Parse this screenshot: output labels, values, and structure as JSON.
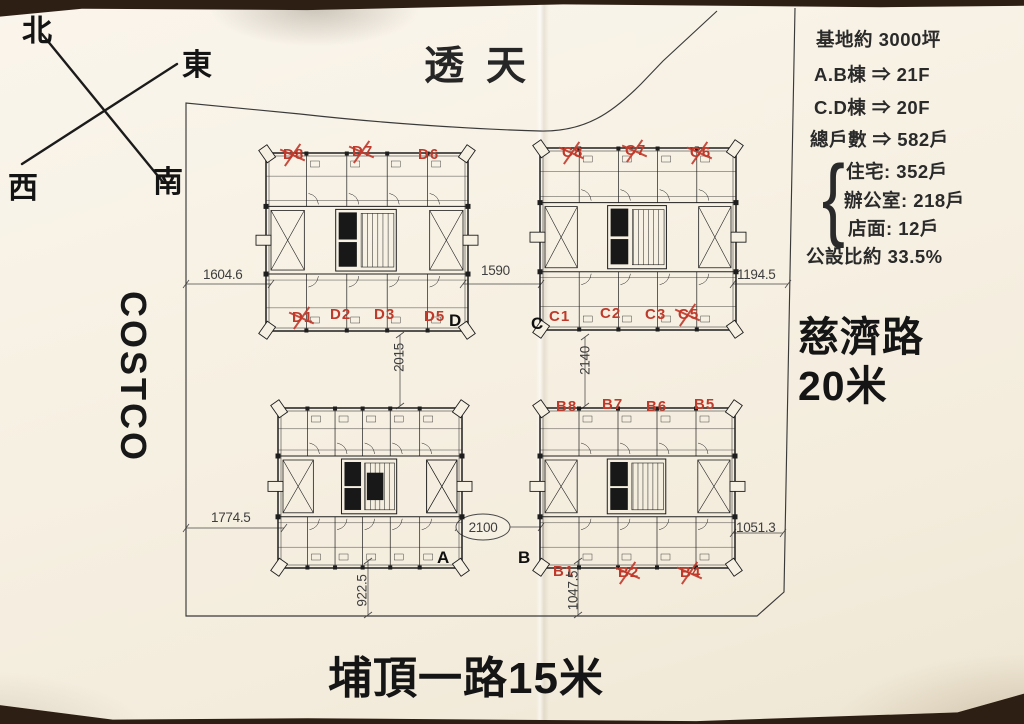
{
  "colors": {
    "paper": "#f6f0e3",
    "table": "#2e1f14",
    "ink": "#1e1e1e",
    "red": "#c03a2b",
    "dim_text": "#3e3e3e"
  },
  "compass": {
    "north": "北",
    "east": "東",
    "south": "南",
    "west": "西"
  },
  "surroundings": {
    "top_area": "透天",
    "left_store": "COSTCO",
    "right_road_name": "慈濟路",
    "right_road_width": "20米",
    "bottom_road": "埔頂一路15米"
  },
  "notes": {
    "site_area": "基地約 3000坪",
    "ab_floors": "A.B棟 ⇒ 21F",
    "cd_floors": "C.D棟 ⇒ 20F",
    "total_units": "總戶數 ⇒ 582戶",
    "brace": "{",
    "breakdown": [
      "住宅: 352戶",
      "辦公室: 218戶",
      "店面: 12戶"
    ],
    "public_ratio": "公設比約 33.5%"
  },
  "dimensions": [
    {
      "id": "dim-1604-6",
      "text": "1604.6"
    },
    {
      "id": "dim-1590",
      "text": "1590"
    },
    {
      "id": "dim-1194-5",
      "text": "1194.5"
    },
    {
      "id": "dim-2015",
      "text": "2015"
    },
    {
      "id": "dim-2140",
      "text": "2140"
    },
    {
      "id": "dim-1774-5",
      "text": "1774.5"
    },
    {
      "id": "dim-2100",
      "text": "2100",
      "circled": true
    },
    {
      "id": "dim-1051-3",
      "text": "1051.3"
    },
    {
      "id": "dim-922-5",
      "text": "922.5"
    },
    {
      "id": "dim-1047-5",
      "text": "1047.5"
    }
  ],
  "buildings": [
    {
      "id": "D",
      "corner_letter": "D",
      "units": [
        {
          "label": "D8",
          "crossed": true
        },
        {
          "label": "D7",
          "crossed": true
        },
        {
          "label": "D6",
          "crossed": false
        },
        {
          "label": "D1",
          "crossed": true
        },
        {
          "label": "D2",
          "crossed": false
        },
        {
          "label": "D3",
          "crossed": false
        },
        {
          "label": "D5",
          "crossed": false
        }
      ]
    },
    {
      "id": "C",
      "corner_letter": "C",
      "units": [
        {
          "label": "C8",
          "crossed": true
        },
        {
          "label": "C7",
          "crossed": true
        },
        {
          "label": "C6",
          "crossed": true
        },
        {
          "label": "C1",
          "crossed": false
        },
        {
          "label": "C2",
          "crossed": false
        },
        {
          "label": "C3",
          "crossed": false
        },
        {
          "label": "C5",
          "crossed": true
        }
      ]
    },
    {
      "id": "A",
      "corner_letter": "A",
      "units": []
    },
    {
      "id": "B",
      "corner_letter": "B",
      "units": [
        {
          "label": "B8",
          "crossed": false
        },
        {
          "label": "B7",
          "crossed": false
        },
        {
          "label": "B6",
          "crossed": false
        },
        {
          "label": "B5",
          "crossed": false
        },
        {
          "label": "B1",
          "crossed": false
        },
        {
          "label": "B2",
          "crossed": true
        },
        {
          "label": "B4",
          "crossed": true
        }
      ]
    }
  ]
}
